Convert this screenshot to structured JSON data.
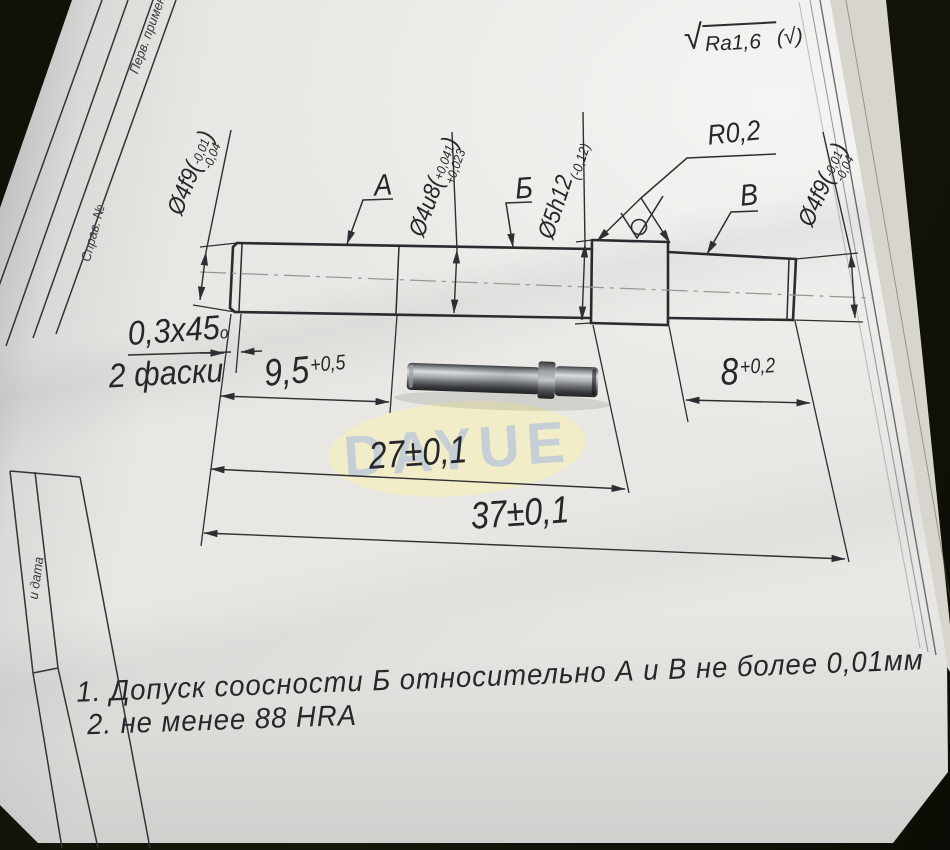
{
  "photo": {
    "background_color": "#13140c",
    "paper_color": "#e8e7e3",
    "line_color": "#2e2e33"
  },
  "watermark": {
    "text": "DAYUE",
    "ellipse_color": "#f1eec6",
    "text_color": "#b9c6da"
  },
  "roughness_note": {
    "check": "√",
    "value": "Ra1,6",
    "open": "(",
    "small_check": "√",
    "close": ")"
  },
  "frame": {
    "col_top": "Перв. примен.",
    "col_mid": "Справ. №",
    "col_bottom": "и дата"
  },
  "dims": {
    "dia_left": {
      "main": "Ø4f9(",
      "upper": "-0,01",
      "lower": "-0,04",
      "close": ")"
    },
    "dia_mid": {
      "main": "Ø4u8(",
      "upper": "+0,041",
      "lower": "+0,023",
      "close": ")"
    },
    "dia_collar": {
      "main": "Ø5h12",
      "tol": "(-0,12)"
    },
    "dia_right": {
      "main": "Ø4f9(",
      "upper": "-0,01",
      "lower": "-0,04",
      "close": ")"
    },
    "datum_a": "A",
    "datum_b": "Б",
    "datum_v": "B",
    "radius": "R0,2",
    "chamfer_value": "0,3x45",
    "chamfer_sup": "o",
    "chamfer_note": "2 фаски",
    "len_9_5": {
      "value": "9,5",
      "tol": "+0,5"
    },
    "len_8": {
      "value": "8",
      "tol": "+0,2"
    },
    "len_27": "27±0,1",
    "len_37": "37±0,1"
  },
  "notes": {
    "line1": "1. Допуск соосности Б относительно А и В не более 0,01мм",
    "line2": "2. не менее 88 HRA"
  }
}
